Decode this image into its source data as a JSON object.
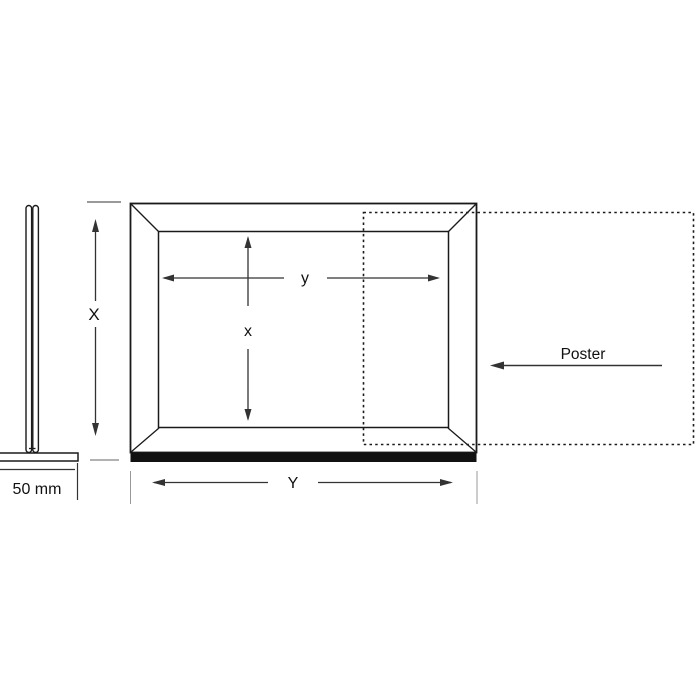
{
  "diagram": {
    "type": "technical-diagram",
    "subject": "poster-frame-with-base-dimension-drawing",
    "views": {
      "side_profile": {
        "base_dimension_label": "50 mm"
      },
      "front": {
        "outer_height_label": "X",
        "outer_width_label": "Y",
        "visible_height_label": "x",
        "visible_width_label": "y"
      },
      "poster_insert": {
        "label": "Poster",
        "insert_direction": "left"
      }
    },
    "colors": {
      "line": "#1a1a1a",
      "dimension_line": "#333333",
      "extension_line": "#999999",
      "frame_bottom_fill": "#111111",
      "background": "#ffffff"
    }
  }
}
